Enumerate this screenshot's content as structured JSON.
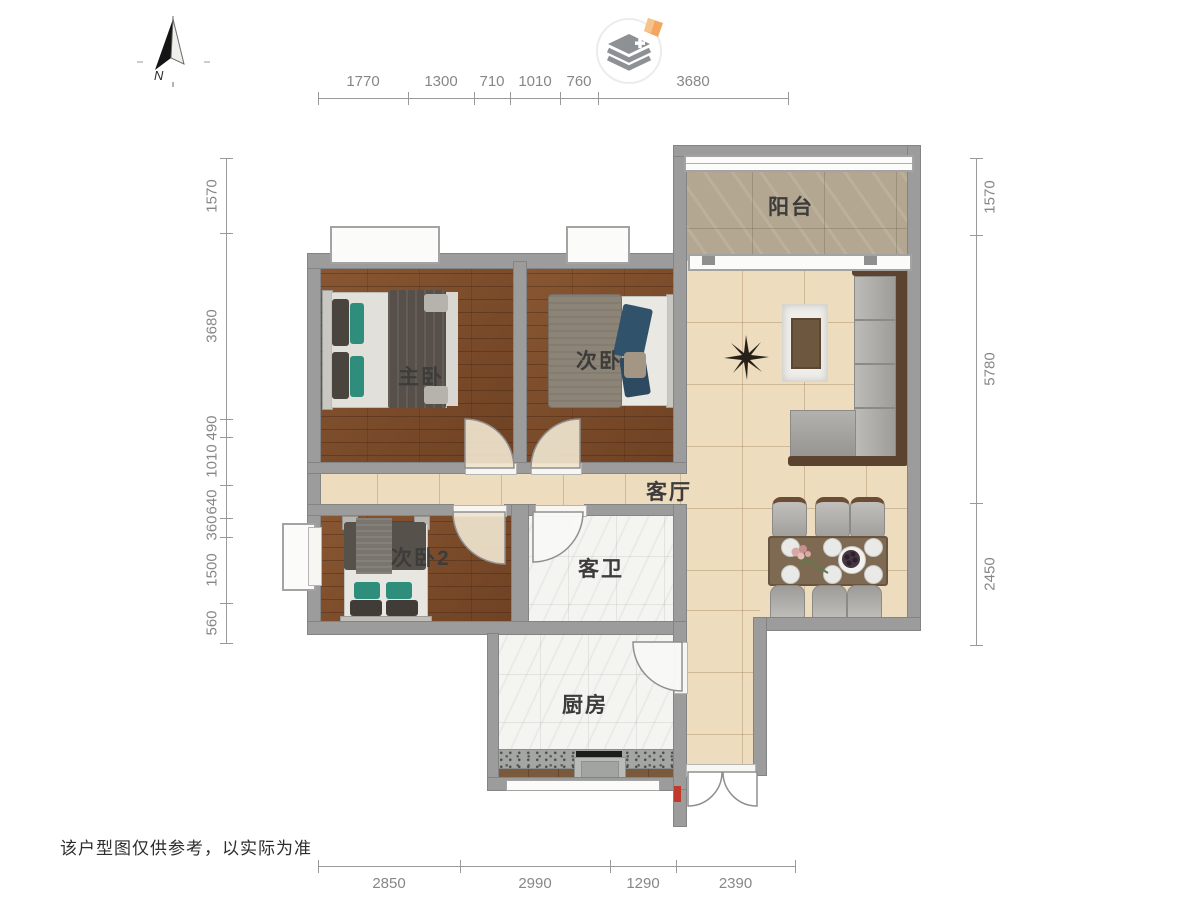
{
  "page": {
    "disclaimer": "该户型图仅供参考，以实际为准"
  },
  "compass": {
    "label": "N"
  },
  "logo": {
    "icon": "layers-plus-with-orange-diamond"
  },
  "rooms": [
    {
      "id": "balcony",
      "label": "阳台"
    },
    {
      "id": "master-bedroom",
      "label": "主卧"
    },
    {
      "id": "bedroom-2",
      "label": "次卧"
    },
    {
      "id": "bedroom-3",
      "label": "次卧2"
    },
    {
      "id": "living-room",
      "label": "客厅"
    },
    {
      "id": "guest-bathroom",
      "label": "客卫"
    },
    {
      "id": "kitchen",
      "label": "厨房"
    }
  ],
  "dimensions": {
    "top": [
      "1770",
      "1300",
      "710",
      "1010",
      "760",
      "3680"
    ],
    "bottom": [
      "2850",
      "2990",
      "1290",
      "2390"
    ],
    "left": [
      "1570",
      "3680",
      "490",
      "1010",
      "640",
      "360",
      "1500",
      "560"
    ],
    "right": [
      "1570",
      "5780",
      "2450"
    ]
  },
  "colors": {
    "wall": "#9c9c9c",
    "wood_floor": "#7c4a28",
    "tile_floor": "#eedcbf",
    "marble_floor": "#f4f4f1",
    "stone_floor": "#b3a791",
    "sofa_gray": "#a7a5a1",
    "sofa_frame_brown": "#5c432f",
    "teal_pillow": "#2f8d7c",
    "navy_clothes": "#31526b",
    "logo_orange": "#f2a65e",
    "accent_red": "#c0392b"
  }
}
